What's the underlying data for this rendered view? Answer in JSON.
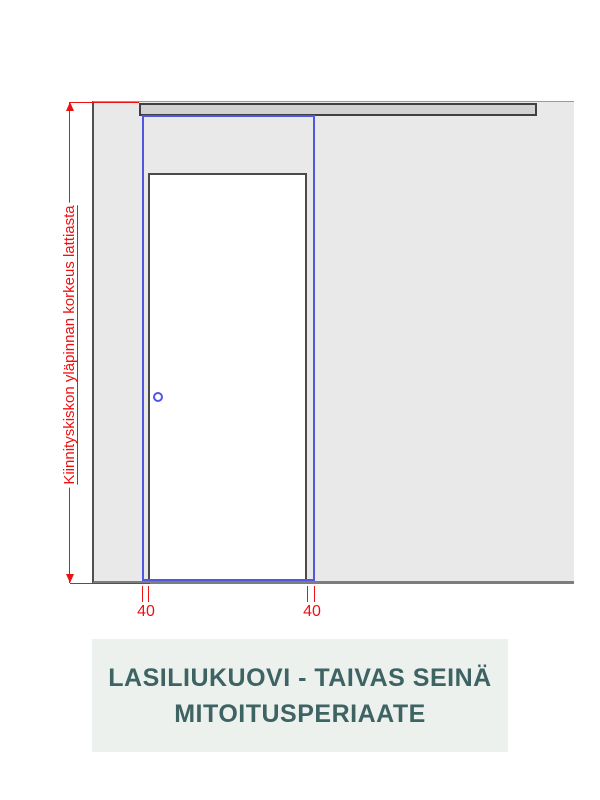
{
  "diagram": {
    "left_dimension_label": "Kiinnityskiskon yläpinnan korkeus lattiasta",
    "bottom_left_dimension": "40",
    "bottom_right_dimension": "40",
    "elements": {
      "wall": "seinä",
      "mounting_rail": "kiinnityskisko",
      "door_opening": "oviaukko",
      "glass_panel": "lasiliukuovi",
      "handle": "vedin"
    }
  },
  "title": {
    "line1": "LASILIUKUOVI - TAIVAS SEINÄ",
    "line2": "MITOITUSPERIAATE"
  },
  "colors": {
    "dimension_red": "#ee1111",
    "panel_blue": "#5156e4",
    "wall_fill": "#e9e9e9",
    "rail_fill": "#d2d2d2",
    "title_text": "#3d6363",
    "title_bg": "#edf1ed"
  }
}
